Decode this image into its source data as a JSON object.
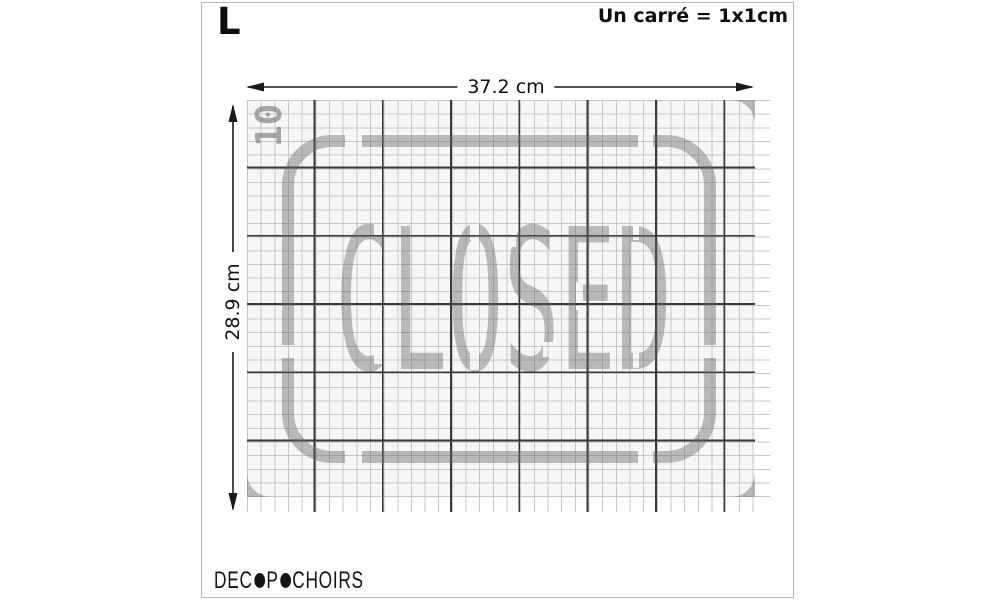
{
  "panel": {
    "size_label": "L",
    "scale_note": "Un carré = 1x1cm"
  },
  "dimensions": {
    "width_label": "37.2 cm",
    "height_label": "28.9 cm"
  },
  "stencil": {
    "word": "CLOSED",
    "height_marker": "10"
  },
  "logo": {
    "part1": "DEC",
    "part2": "P",
    "part3": "CHOIRS"
  },
  "colors": {
    "stencil_gray": "#b3b3b3",
    "grid_heavy_line": "#3a3a3a",
    "grid_light_line": "#c6c6c6",
    "grid_background": "#f6f6f6",
    "annotation_black": "#111111"
  }
}
